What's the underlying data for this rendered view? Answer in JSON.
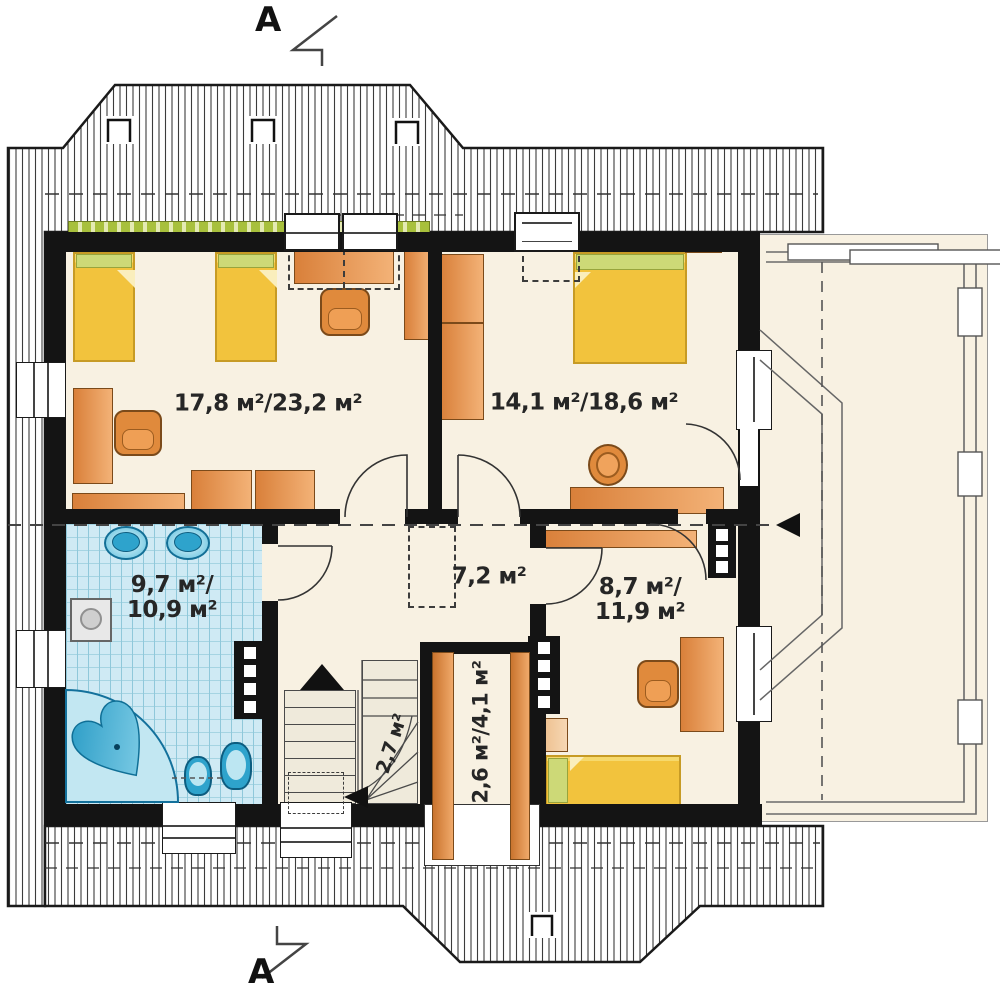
{
  "section_markers": {
    "top": "A",
    "bottom": "A"
  },
  "rooms": {
    "children_room": {
      "label": "17,8 м²/23,2 м²"
    },
    "bedroom": {
      "label": "14,1 м²/18,6 м²"
    },
    "bathroom": {
      "line1": "9,7 м²/",
      "line2": "10,9 м²"
    },
    "hall": {
      "label": "7,2 м²"
    },
    "small_bedroom": {
      "line1": "8,7 м²/",
      "line2": "11,9 м²"
    },
    "closet": {
      "label": "2,6 м²/4,1 м²"
    },
    "stairs": {
      "winder_label": "2,7 м²"
    }
  },
  "colors": {
    "wall": "#141414",
    "floor": "#f8f1e2",
    "furniture_orange": "#e0873c",
    "bed_yellow": "#f2c33d",
    "pillow_green": "#cdd977",
    "tile_blue": "#cfeaf4",
    "fixture_blue": "#31a9d2",
    "plants_green": "#a8c03c",
    "roof_hatch_line": "#3c3c3c"
  }
}
